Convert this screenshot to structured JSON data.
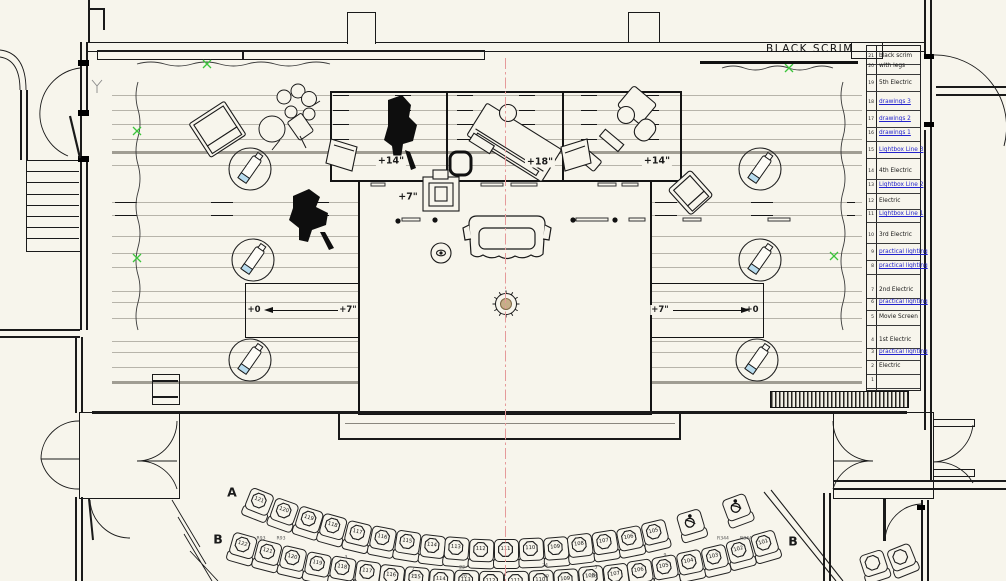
{
  "drawing": {
    "scrim_label": "BLACK SCRIM",
    "platform_labels": {
      "left": "+14\"",
      "center": "+18\"",
      "right": "+14\"",
      "thrust": "+7\""
    },
    "ramps": {
      "left": {
        "start": "+0",
        "end": "+7\""
      },
      "right": {
        "start": "+7\"",
        "end": "+0"
      }
    }
  },
  "lineset_schedule": {
    "rows": [
      {
        "num": "21",
        "label": "black scrim",
        "blue": false,
        "y": 57
      },
      {
        "num": "20",
        "label": "with legs",
        "blue": false,
        "y": 67
      },
      {
        "num": "19",
        "label": "5th Electric",
        "blue": false,
        "y": 84
      },
      {
        "num": "18",
        "label": "drawings 3",
        "blue": true,
        "y": 103
      },
      {
        "num": "17",
        "label": "drawings 2",
        "blue": true,
        "y": 120
      },
      {
        "num": "16",
        "label": "drawings 1",
        "blue": true,
        "y": 134
      },
      {
        "num": "15",
        "label": "Lightbox Line 3",
        "blue": true,
        "y": 151
      },
      {
        "num": "14",
        "label": "4th Electric",
        "blue": false,
        "y": 172
      },
      {
        "num": "13",
        "label": "Lightbox Line 2",
        "blue": true,
        "y": 186
      },
      {
        "num": "12",
        "label": "Electric",
        "blue": false,
        "y": 202
      },
      {
        "num": "11",
        "label": "Lightbox Line 1",
        "blue": true,
        "y": 215
      },
      {
        "num": "10",
        "label": "3rd Electric",
        "blue": false,
        "y": 236
      },
      {
        "num": "9",
        "label": "practical lighting",
        "blue": true,
        "y": 253
      },
      {
        "num": "8",
        "label": "practical lighting",
        "blue": true,
        "y": 267
      },
      {
        "num": "7",
        "label": "2nd Electric",
        "blue": false,
        "y": 291
      },
      {
        "num": "6",
        "label": "practical lighting",
        "blue": true,
        "y": 303
      },
      {
        "num": "5",
        "label": "Movie Screen",
        "blue": false,
        "y": 318
      },
      {
        "num": "4",
        "label": "1st Electric",
        "blue": false,
        "y": 341
      },
      {
        "num": "3",
        "label": "practical lighting",
        "blue": true,
        "y": 353
      },
      {
        "num": "2",
        "label": "Electric",
        "blue": false,
        "y": 367
      },
      {
        "num": "1",
        "label": "",
        "blue": false,
        "y": 381
      }
    ]
  },
  "stage_lines": [
    {
      "y": 95
    },
    {
      "y": 110
    },
    {
      "y": 124
    },
    {
      "y": 139
    },
    {
      "y": 151,
      "thick": true
    },
    {
      "y": 165
    },
    {
      "y": 202
    },
    {
      "y": 215
    },
    {
      "y": 236
    },
    {
      "y": 253
    },
    {
      "y": 267
    },
    {
      "y": 291
    },
    {
      "y": 302
    },
    {
      "y": 318
    },
    {
      "y": 341
    },
    {
      "y": 352
    },
    {
      "y": 367
    },
    {
      "y": 381,
      "thick": true
    }
  ],
  "seating": {
    "row_labels": [
      {
        "text": "A",
        "x": 232,
        "y": 492
      },
      {
        "text": "B",
        "x": 218,
        "y": 539
      },
      {
        "text": "B",
        "x": 793,
        "y": 541
      }
    ],
    "row_a_numbers": [
      "121",
      "120",
      "119",
      "118",
      "117",
      "116",
      "115",
      "114",
      "113",
      "112",
      "111",
      "110",
      "109",
      "108",
      "107",
      "106",
      "105"
    ],
    "row_b_numbers": [
      "122",
      "121",
      "120",
      "119",
      "118",
      "117",
      "116",
      "115",
      "114",
      "113",
      "112",
      "111",
      "110",
      "109",
      "108",
      "107",
      "106",
      "105",
      "104",
      "103",
      "102",
      "101"
    ],
    "row_a_wheelchair_count": 2,
    "tiny_marks": [
      {
        "text": "R93",
        "x": 261,
        "y": 539
      },
      {
        "text": "R93",
        "x": 281,
        "y": 539
      },
      {
        "text": "R344",
        "x": 723,
        "y": 539
      },
      {
        "text": "R344",
        "x": 746,
        "y": 539
      },
      {
        "text": "3",
        "x": 346,
        "y": 558
      },
      {
        "text": "7",
        "x": 413,
        "y": 570
      },
      {
        "text": "25",
        "x": 414,
        "y": 577
      },
      {
        "text": "23",
        "x": 462,
        "y": 568
      },
      {
        "text": "26",
        "x": 464,
        "y": 577
      },
      {
        "text": "24",
        "x": 545,
        "y": 566
      },
      {
        "text": "29",
        "x": 546,
        "y": 577
      },
      {
        "text": "5",
        "x": 596,
        "y": 568
      },
      {
        "text": "28",
        "x": 594,
        "y": 577
      },
      {
        "text": "9",
        "x": 665,
        "y": 556
      }
    ]
  },
  "green_marks": [
    [
      207,
      64
    ],
    [
      789,
      68
    ],
    [
      137,
      131
    ],
    [
      834,
      256
    ],
    [
      137,
      258
    ]
  ],
  "colors": {
    "background": "#f7f5ec",
    "line": "#1a1a1a",
    "link_blue": "#2222cc",
    "centerline_red": "#e59a9a",
    "green_mark": "#3bc43b",
    "center_dot_tan": "#c6ae88",
    "fixture_tip_blue": "#b8dcee"
  }
}
